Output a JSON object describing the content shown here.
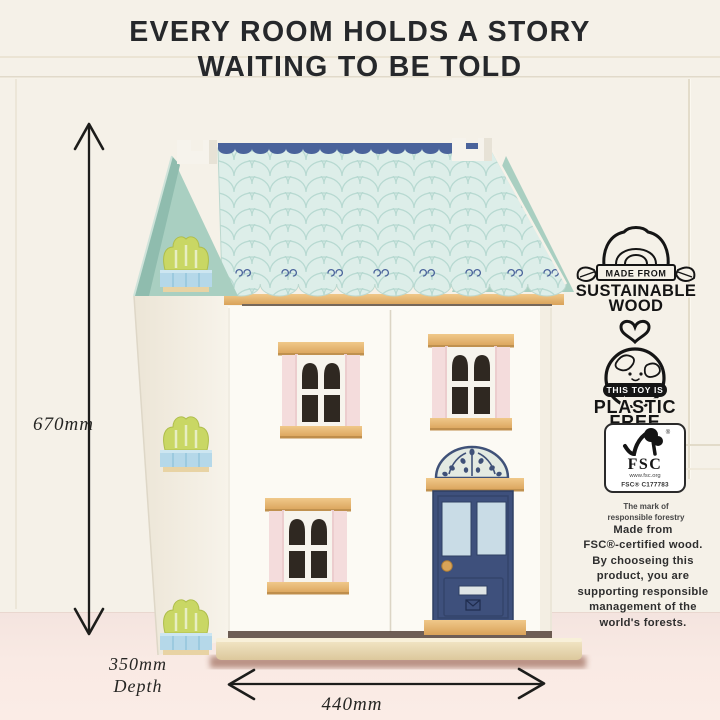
{
  "title": {
    "line1": "EVERY ROOM HOLDS A STORY",
    "line2": "WAITING TO BE TOLD"
  },
  "dimensions": {
    "height": "670mm",
    "depth": "350mm\nDepth",
    "width": "440mm"
  },
  "badges": {
    "sustainable_wood": {
      "icon": "log-with-leaves-icon",
      "banner": "MADE FROM",
      "title_line1": "SUSTAINABLE",
      "title_line2": "WOOD"
    },
    "plastic_free": {
      "icon": "earth-heart-icon",
      "banner": "THIS TOY IS",
      "title_line1": "PLASTIC",
      "title_line2": "FREE"
    },
    "fsc": {
      "icon": "fsc-check-tree-icon",
      "registered_mark": "®",
      "acronym": "FSC",
      "website": "www.fsc.org",
      "license": "FSC® C177783",
      "tagline": "The mark of\nresponsible forestry"
    }
  },
  "description": "Made from\nFSC®-certified wood.\nBy chooseing this\nproduct, you are\nsupporting responsible\nmanagement of the\nworld's forests.",
  "colors": {
    "wall": "#f5f1e8",
    "floor": "#f8e9e4",
    "roof_mint": "#ddeee9",
    "roof_pattern": "#b7d9d1",
    "ridge_navy": "#4a639b",
    "gable_mint": "#a9cfc1",
    "shutter_pink": "#f4dbdb",
    "wood_tan": "#e2b06d",
    "door_navy": "#3e507c",
    "bush_green": "#c8d663",
    "planter_blue": "#b4d8e9",
    "ink": "#1d1d1b"
  }
}
